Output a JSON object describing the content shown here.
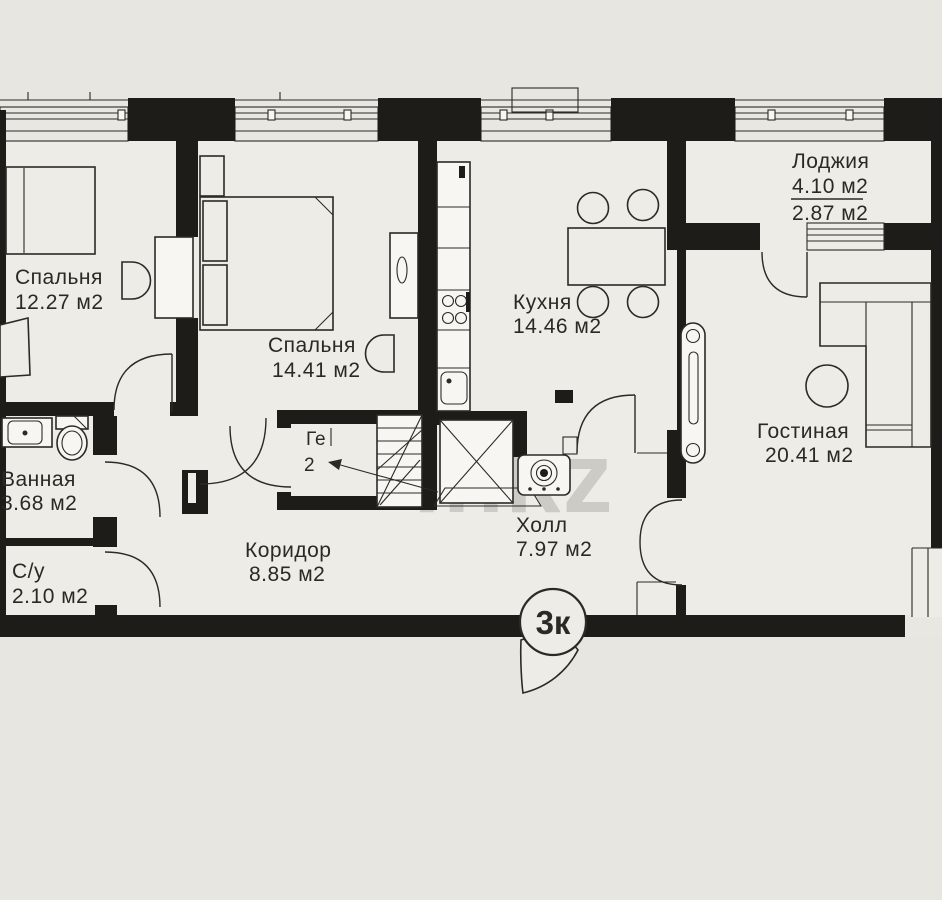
{
  "floorplan": {
    "badge": "3к",
    "watermark": {
      "left": "ln",
      "right": "kz"
    },
    "rooms": {
      "bedroom1": {
        "name": "Спальня",
        "area": "12.27 м2"
      },
      "bedroom2": {
        "name": "Спальня",
        "area": "14.41 м2"
      },
      "kitchen": {
        "name": "Кухня",
        "area": "14.46 м2"
      },
      "loggia": {
        "name": "Лоджия",
        "area_total": "4.10 м2",
        "area_reduced": "2.87 м2"
      },
      "living": {
        "name": "Гостиная",
        "area": "20.41 м2"
      },
      "bathroom": {
        "name": "Ванная",
        "area": "3.68 м2"
      },
      "wc": {
        "name": "С/у",
        "area": "2.10 м2"
      },
      "corridor": {
        "name": "Коридор",
        "area": "8.85 м2"
      },
      "hall": {
        "name": "Холл",
        "area": "7.97 м2"
      },
      "closet": {
        "name": "Ге",
        "area": "2"
      }
    },
    "colors": {
      "background": "#e8e6e1",
      "floor": "#edece7",
      "wall": "#1d1c19",
      "line": "#2c2a26",
      "fixture": "#f7f6f3",
      "watermark": "#a19e97"
    }
  }
}
